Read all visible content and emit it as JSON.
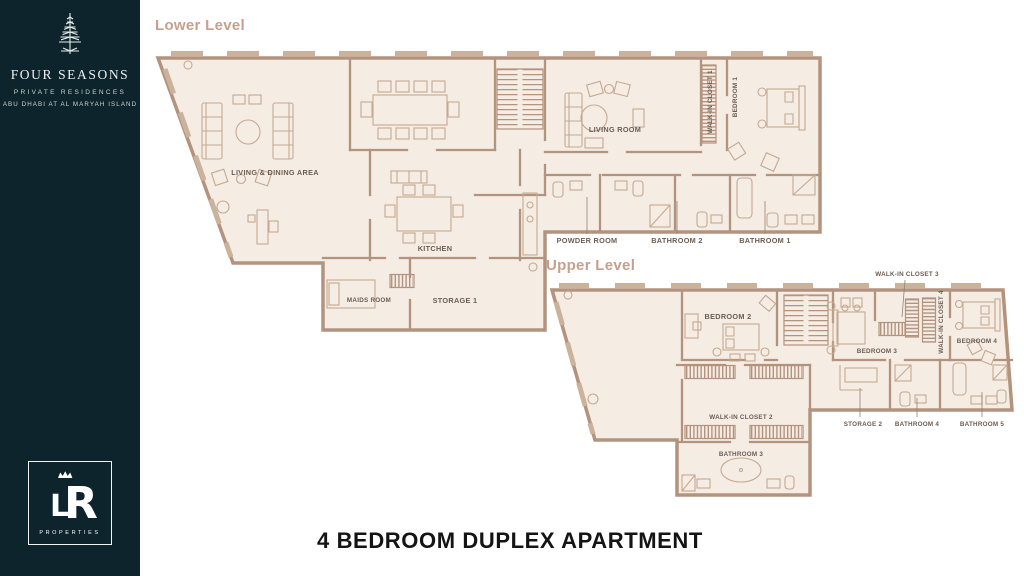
{
  "colors": {
    "sidebar_bg": "#0d242c",
    "wall": "#b3937e",
    "floor_fill": "#f5ece4",
    "plan_label": "#6b5d52",
    "level_heading": "#c79f8e",
    "title_text": "#141414"
  },
  "sidebar": {
    "brand": "FOUR SEASONS",
    "brand_sub": "PRIVATE RESIDENCES",
    "brand_location": "ABU DHABI AT AL MARYAH ISLAND",
    "monogram_l": "L",
    "monogram_r": "R",
    "footer_label": "PROPERTIES"
  },
  "lower": {
    "heading": "Lower Level",
    "labels": {
      "living_dining": "LIVING & DINING AREA",
      "kitchen": "KITCHEN",
      "maids": "MAIDS ROOM",
      "storage1": "STORAGE 1",
      "living_room": "LIVING ROOM",
      "wic1": "WALK-IN CLOSET 1",
      "bedroom1": "BEDROOM 1",
      "powder": "POWDER ROOM",
      "bath2": "BATHROOM 2",
      "bath1": "BATHROOM 1"
    }
  },
  "upper": {
    "heading": "Upper Level",
    "labels": {
      "bedroom2": "BEDROOM 2",
      "wic2": "WALK-IN CLOSET 2",
      "bath3": "BATHROOM 3",
      "bedroom3": "BEDROOM 3",
      "wic3": "WALK-IN CLOSET 3",
      "wic4": "WALK-IN CLOSET 4",
      "bedroom4": "BEDROOM 4",
      "storage2": "STORAGE 2",
      "bath4": "BATHROOM 4",
      "bath5": "BATHROOM 5"
    }
  },
  "footer": {
    "title": "4 BEDROOM DUPLEX APARTMENT"
  }
}
